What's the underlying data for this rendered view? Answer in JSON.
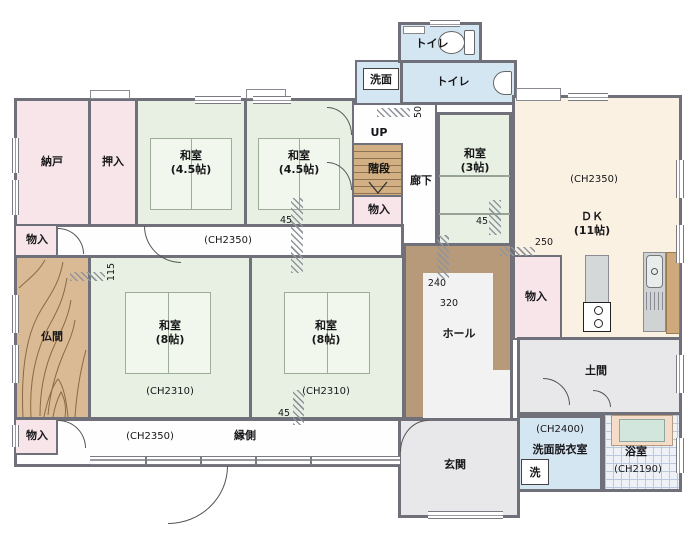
{
  "floorplan": {
    "type": "japanese-house-1f-madori",
    "rooms": {
      "nando": {
        "label": "納戸"
      },
      "oshiire": {
        "label": "押入"
      },
      "washitsu45a": {
        "label": "和室",
        "size": "(4.5帖)"
      },
      "washitsu45b": {
        "label": "和室",
        "size": "(4.5帖)"
      },
      "senmen": {
        "label": "洗面"
      },
      "toilet1": {
        "label": "トイレ"
      },
      "toilet2": {
        "label": "トイレ"
      },
      "stairs": {
        "label": "階段",
        "up": "UP"
      },
      "monoire_stairs": {
        "label": "物入"
      },
      "rouka": {
        "label": "廊下"
      },
      "washitsu3": {
        "label": "和室",
        "size": "(3帖)"
      },
      "dk": {
        "label": "ＤＫ",
        "size": "(11帖)",
        "ch": "(CH2350)"
      },
      "corridor_mid": {
        "ch": "(CH2350)"
      },
      "monoire_nw": {
        "label": "物入"
      },
      "butsuma": {
        "label": "仏間"
      },
      "washitsu8a": {
        "label": "和室",
        "size": "(8帖)",
        "ch": "(CH2310)"
      },
      "washitsu8b": {
        "label": "和室",
        "size": "(8帖)",
        "ch": "(CH2310)"
      },
      "hall": {
        "label": "ホール"
      },
      "monoire_dk": {
        "label": "物入"
      },
      "doma": {
        "label": "土間"
      },
      "monoire_sw": {
        "label": "物入"
      },
      "engawa": {
        "label": "縁側",
        "ch": "(CH2350)"
      },
      "genkan": {
        "label": "玄関"
      },
      "senmen_datsui": {
        "label": "洗面脱衣室",
        "ch": "(CH2400)"
      },
      "laundry": {
        "label": "洗"
      },
      "bath": {
        "label": "浴室",
        "ch": "(CH2190)"
      }
    },
    "dimensions": {
      "d45": "45",
      "d50": "50",
      "d115": "115",
      "d240": "240",
      "d250": "250",
      "d320": "320"
    },
    "colors": {
      "wall": "#70707a",
      "tatami": "#e7f0e2",
      "closet_pink": "#f7e5e9",
      "wood_tan": "#d9ba95",
      "dk_cream": "#fbf1e2",
      "hall_brown": "#b79a7a",
      "earth_gray": "#e8e8ea",
      "wet_blue": "#d5e6f3"
    }
  }
}
